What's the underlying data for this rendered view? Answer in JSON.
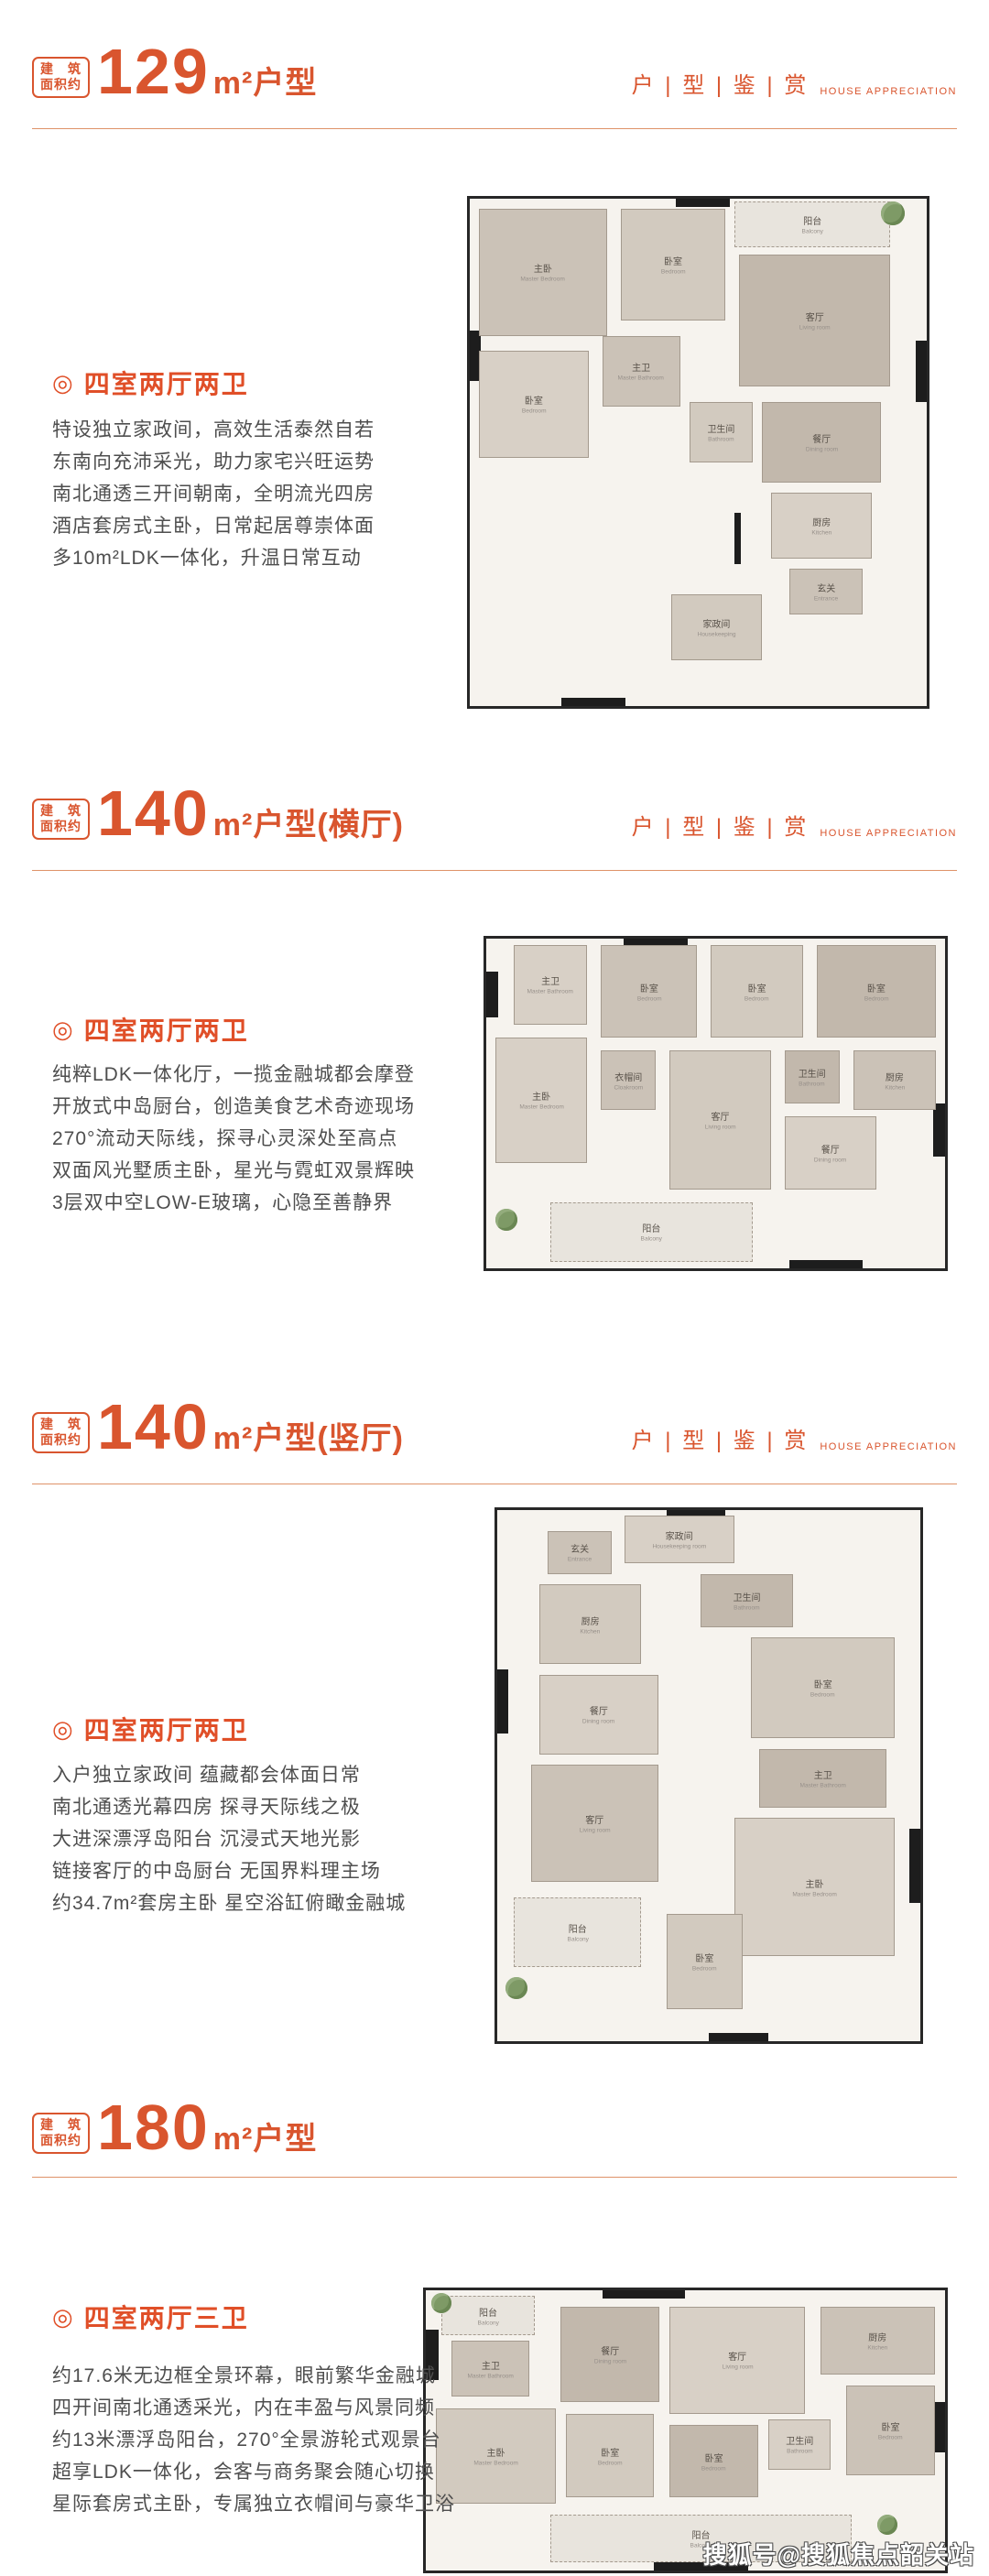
{
  "page": {
    "accent": "#d9552e",
    "watermark": "搜狐号@搜狐焦点韶关站"
  },
  "area_badge": {
    "line1_a": "建",
    "line1_b": "筑",
    "line2": "面积约"
  },
  "right_tag": {
    "cn": "户 | 型 | 鉴 | 赏",
    "en": "HOUSE APPRECIATION"
  },
  "sections": [
    {
      "area": "129",
      "unit_type": "m²户型",
      "variant": "",
      "room_type": "四室两厅两卫",
      "title_mark": "◎",
      "paragraph": [
        "特设独立家政间，高效生活泰然自若",
        "东南向充沛采光，助力家宅兴旺运势",
        "南北通透三开间朝南，全明流光四房",
        "酒店套房式主卧，日常起居尊崇体面",
        "多10m²LDK一体化，升温日常互动"
      ],
      "plan": {
        "rooms": [
          {
            "cn": "阳台",
            "en": "Balcony",
            "x": 58,
            "y": 0.5,
            "w": 34,
            "h": 9,
            "t": "balcony"
          },
          {
            "cn": "主卧",
            "en": "Master Bedroom",
            "x": 2,
            "y": 2,
            "w": 28,
            "h": 25
          },
          {
            "cn": "卧室",
            "en": "Bedroom",
            "x": 33,
            "y": 2,
            "w": 23,
            "h": 22
          },
          {
            "cn": "客厅",
            "en": "Living room",
            "x": 59,
            "y": 11,
            "w": 33,
            "h": 26
          },
          {
            "cn": "卧室",
            "en": "Bedroom",
            "x": 2,
            "y": 30,
            "w": 24,
            "h": 21
          },
          {
            "cn": "主卫",
            "en": "Master Bathroom",
            "x": 29,
            "y": 27,
            "w": 17,
            "h": 14
          },
          {
            "cn": "卫生间",
            "en": "Bathroom",
            "x": 48,
            "y": 40,
            "w": 14,
            "h": 12
          },
          {
            "cn": "餐厅",
            "en": "Dining room",
            "x": 64,
            "y": 40,
            "w": 26,
            "h": 16
          },
          {
            "cn": "厨房",
            "en": "Kitchen",
            "x": 66,
            "y": 58,
            "w": 22,
            "h": 13
          },
          {
            "cn": "玄关",
            "en": "Entrance",
            "x": 70,
            "y": 73,
            "w": 16,
            "h": 9
          },
          {
            "cn": "家政间",
            "en": "Housekeeping",
            "x": 44,
            "y": 78,
            "w": 20,
            "h": 13
          }
        ],
        "walls": [
          [
            0,
            26,
            2.5,
            10
          ],
          [
            45,
            0,
            12,
            1.6
          ],
          [
            97.5,
            28,
            2.5,
            12
          ],
          [
            20,
            98.4,
            14,
            1.6
          ],
          [
            58,
            62,
            1.4,
            10
          ]
        ],
        "plants": [
          {
            "x": 90,
            "y": 0.5,
            "s": 26
          }
        ]
      }
    },
    {
      "area": "140",
      "unit_type": "m²户型",
      "variant": "(横厅)",
      "room_type": "四室两厅两卫",
      "title_mark": "◎",
      "paragraph": [
        "纯粹LDK一体化厅，一揽金融城都会摩登",
        "开放式中岛厨台，创造美食艺术奇迹现场",
        "270°流动天际线，探寻心灵深处至高点",
        "双面风光墅质主卧，星光与霓虹双景辉映",
        "3层双中空LOW-E玻璃，心隐至善静界"
      ],
      "plan": {
        "rooms": [
          {
            "cn": "主卫",
            "en": "Master Bathroom",
            "x": 6,
            "y": 2,
            "w": 16,
            "h": 24
          },
          {
            "cn": "卧室",
            "en": "Bedroom",
            "x": 25,
            "y": 2,
            "w": 21,
            "h": 28
          },
          {
            "cn": "卧室",
            "en": "Bedroom",
            "x": 49,
            "y": 2,
            "w": 20,
            "h": 28
          },
          {
            "cn": "卧室",
            "en": "Bedroom",
            "x": 72,
            "y": 2,
            "w": 26,
            "h": 28
          },
          {
            "cn": "主卧",
            "en": "Master Bedroom",
            "x": 2,
            "y": 30,
            "w": 20,
            "h": 38
          },
          {
            "cn": "衣帽间",
            "en": "Cloakroom",
            "x": 25,
            "y": 34,
            "w": 12,
            "h": 18
          },
          {
            "cn": "客厅",
            "en": "Living room",
            "x": 40,
            "y": 34,
            "w": 22,
            "h": 42
          },
          {
            "cn": "卫生间",
            "en": "Bathroom",
            "x": 65,
            "y": 34,
            "w": 12,
            "h": 16
          },
          {
            "cn": "餐厅",
            "en": "Dining room",
            "x": 65,
            "y": 54,
            "w": 20,
            "h": 22
          },
          {
            "cn": "厨房",
            "en": "Kitchen",
            "x": 80,
            "y": 34,
            "w": 18,
            "h": 18
          },
          {
            "cn": "阳台",
            "en": "Balcony",
            "x": 14,
            "y": 80,
            "w": 44,
            "h": 18,
            "t": "balcony"
          }
        ],
        "walls": [
          [
            0,
            10,
            2.5,
            14
          ],
          [
            30,
            0,
            14,
            2.4
          ],
          [
            97.5,
            50,
            2.5,
            16
          ],
          [
            66,
            97.6,
            16,
            2.4
          ]
        ],
        "plants": [
          {
            "x": 2,
            "y": 82,
            "s": 24
          }
        ]
      }
    },
    {
      "area": "140",
      "unit_type": "m²户型",
      "variant": "(竖厅)",
      "room_type": "四室两厅两卫",
      "title_mark": "◎",
      "paragraph": [
        "入户独立家政间 蕴藏都会体面日常",
        "南北通透光幕四房 探寻天际线之极",
        "大进深漂浮岛阳台 沉浸式天地光影",
        "链接客厅的中岛厨台 无国界料理主场",
        "约34.7m²套房主卧 星空浴缸俯瞰金融城"
      ],
      "plan": {
        "rooms": [
          {
            "cn": "家政间",
            "en": "Housekeeping room",
            "x": 30,
            "y": 1,
            "w": 26,
            "h": 9
          },
          {
            "cn": "玄关",
            "en": "Entrance",
            "x": 12,
            "y": 4,
            "w": 15,
            "h": 8
          },
          {
            "cn": "厨房",
            "en": "Kitchen",
            "x": 10,
            "y": 14,
            "w": 24,
            "h": 15
          },
          {
            "cn": "卫生间",
            "en": "Bathroom",
            "x": 48,
            "y": 12,
            "w": 22,
            "h": 10
          },
          {
            "cn": "餐厅",
            "en": "Dining room",
            "x": 10,
            "y": 31,
            "w": 28,
            "h": 15
          },
          {
            "cn": "客厅",
            "en": "Living room",
            "x": 8,
            "y": 48,
            "w": 30,
            "h": 22
          },
          {
            "cn": "卧室",
            "en": "Bedroom",
            "x": 60,
            "y": 24,
            "w": 34,
            "h": 19
          },
          {
            "cn": "主卫",
            "en": "Master Bathroom",
            "x": 62,
            "y": 45,
            "w": 30,
            "h": 11
          },
          {
            "cn": "主卧",
            "en": "Master Bedroom",
            "x": 56,
            "y": 58,
            "w": 38,
            "h": 26
          },
          {
            "cn": "阳台",
            "en": "Balcony",
            "x": 4,
            "y": 73,
            "w": 30,
            "h": 13,
            "t": "balcony"
          },
          {
            "cn": "卧室",
            "en": "Bedroom",
            "x": 40,
            "y": 76,
            "w": 18,
            "h": 18
          }
        ],
        "walls": [
          [
            0,
            30,
            2.6,
            12
          ],
          [
            40,
            0,
            14,
            1.6
          ],
          [
            97.4,
            60,
            2.6,
            14
          ],
          [
            50,
            98.4,
            14,
            1.6
          ]
        ],
        "plants": [
          {
            "x": 2,
            "y": 88,
            "s": 24
          }
        ]
      }
    },
    {
      "area": "180",
      "unit_type": "m²户型",
      "variant": "",
      "room_type": "四室两厅三卫",
      "title_mark": "◎",
      "paragraph": [
        "约17.6米无边框全景环幕，眼前繁华金融城",
        "四开间南北通透采光，内在丰盈与风景同频",
        "约13米漂浮岛阳台，270°全景游轮式观景台",
        "超享LDK一体化，会客与商务聚会随心切换",
        "星际套房式主卧，专属独立衣帽间与豪华卫浴"
      ],
      "plan": {
        "rooms": [
          {
            "cn": "阳台",
            "en": "Balcony",
            "x": 3,
            "y": 2,
            "w": 18,
            "h": 14,
            "t": "balcony"
          },
          {
            "cn": "主卫",
            "en": "Master Bathroom",
            "x": 5,
            "y": 18,
            "w": 15,
            "h": 20
          },
          {
            "cn": "主卧",
            "en": "Master Bedroom",
            "x": 2,
            "y": 42,
            "w": 23,
            "h": 34
          },
          {
            "cn": "餐厅",
            "en": "Dining room",
            "x": 26,
            "y": 6,
            "w": 19,
            "h": 34
          },
          {
            "cn": "客厅",
            "en": "Living room",
            "x": 47,
            "y": 6,
            "w": 26,
            "h": 38
          },
          {
            "cn": "厨房",
            "en": "Kitchen",
            "x": 76,
            "y": 6,
            "w": 22,
            "h": 24
          },
          {
            "cn": "卧室",
            "en": "Bedroom",
            "x": 27,
            "y": 44,
            "w": 17,
            "h": 30
          },
          {
            "cn": "卧室",
            "en": "Bedroom",
            "x": 47,
            "y": 48,
            "w": 17,
            "h": 26
          },
          {
            "cn": "卫生间",
            "en": "Bathroom",
            "x": 66,
            "y": 46,
            "w": 12,
            "h": 18
          },
          {
            "cn": "卧室",
            "en": "Bedroom",
            "x": 81,
            "y": 34,
            "w": 17,
            "h": 32
          },
          {
            "cn": "阳台",
            "en": "Balcony",
            "x": 24,
            "y": 80,
            "w": 58,
            "h": 17,
            "t": "balcony"
          }
        ],
        "walls": [
          [
            0,
            14,
            2.4,
            18
          ],
          [
            34,
            0,
            16,
            2.8
          ],
          [
            97.6,
            40,
            2.4,
            18
          ],
          [
            44,
            97.2,
            18,
            2.8
          ]
        ],
        "plants": [
          {
            "x": 1,
            "y": 1,
            "s": 22
          },
          {
            "x": 87,
            "y": 80,
            "s": 22
          }
        ]
      }
    }
  ]
}
